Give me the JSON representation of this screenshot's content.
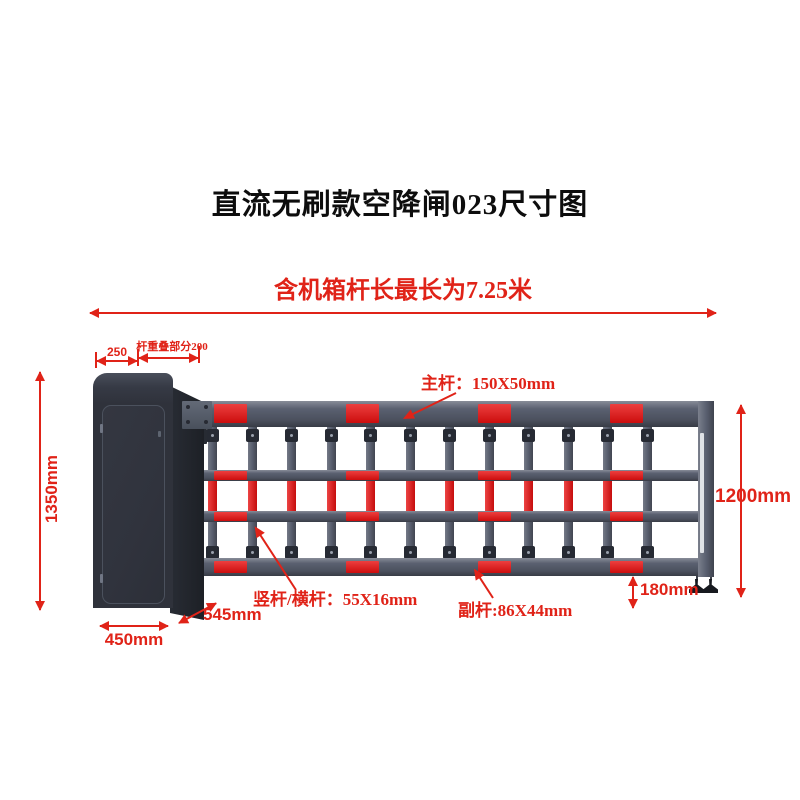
{
  "title": "直流无刷款空降闸023尺寸图",
  "overall_length_note": "含机箱杆长最长为7.25米",
  "dimensions": {
    "cabinet_top_width": "250",
    "pole_overlap": "杆重叠部分200",
    "cabinet_height": "1350mm",
    "cabinet_width": "450mm",
    "cabinet_depth": "545mm",
    "barrier_height": "1200mm",
    "ground_clearance": "180mm"
  },
  "part_labels": {
    "main_pole": "主杆：150X50mm",
    "vertical_horizontal_pole": "竖杆/横杆：55X16mm",
    "auxiliary_pole": "副杆:86X44mm"
  },
  "colors": {
    "dimension_red": "#e02318",
    "reflector_red": "#e80f0f",
    "rail_gray": "#5a6070",
    "cabinet_dark": "#2f323b",
    "title_black": "#0d0d0d"
  },
  "barrier": {
    "post_count": 12,
    "red_post_sections": 11,
    "reflector_columns": 4
  }
}
